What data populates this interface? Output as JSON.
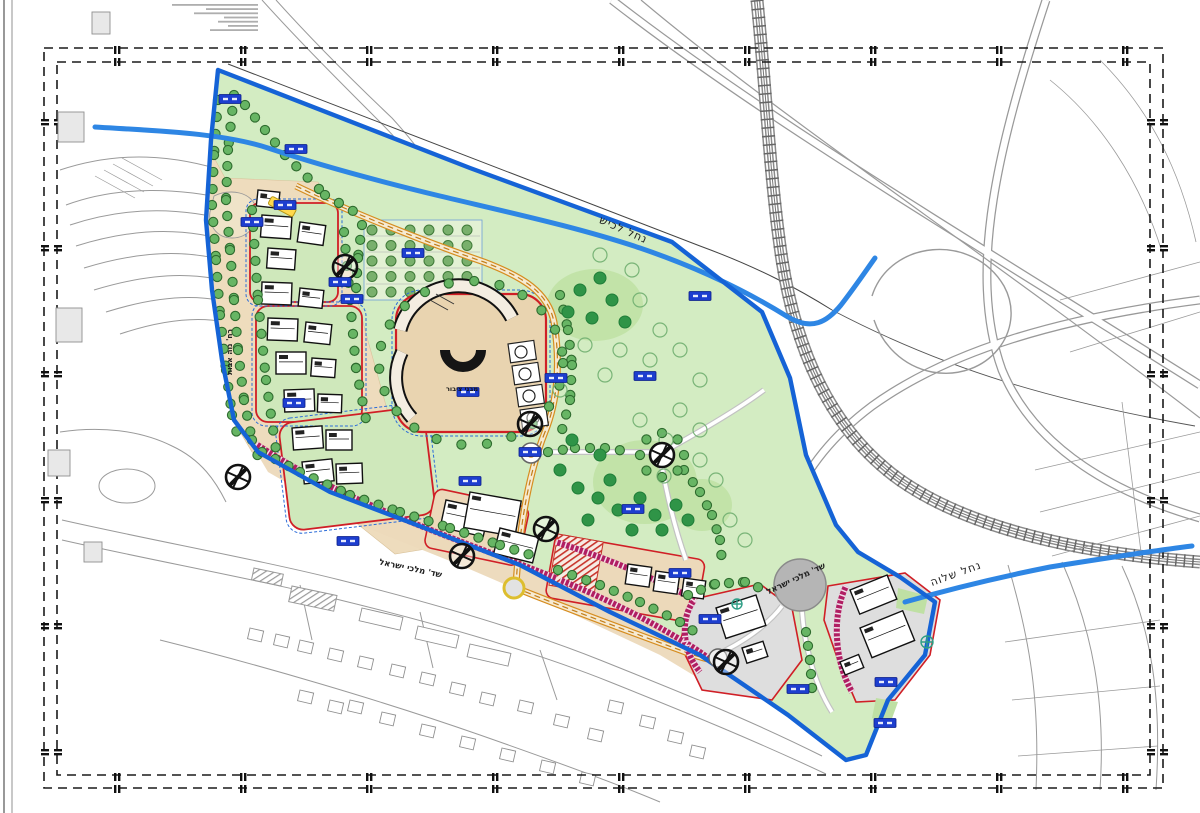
{
  "drawing": {
    "type_hint": "urban masterplan sheet",
    "labels": {
      "stream_north": "נחל לכיש",
      "stream_east": "נחל שלוה",
      "street_south_west": "שד' מלכי ישראל",
      "street_south_roundabout": "שד' מלכי ישראל",
      "street_west_vertical": "רח' נוה אבות",
      "campus_public_buildings": "מבני ציבור"
    },
    "colors": {
      "site_boundary_blue": "#1563d6",
      "stream_blue": "#2e86e4",
      "park_green": "#d3ecc2",
      "parcel_tan": "#ecd9ba",
      "parcel_outline_red": "#d01f26",
      "frontage_band_crimson": "#b01e63",
      "loop_road_orange": "#d68d20",
      "parcel_label_blue": "#1d3ecf",
      "existing_city_gray": "#9a9a9a"
    }
  }
}
